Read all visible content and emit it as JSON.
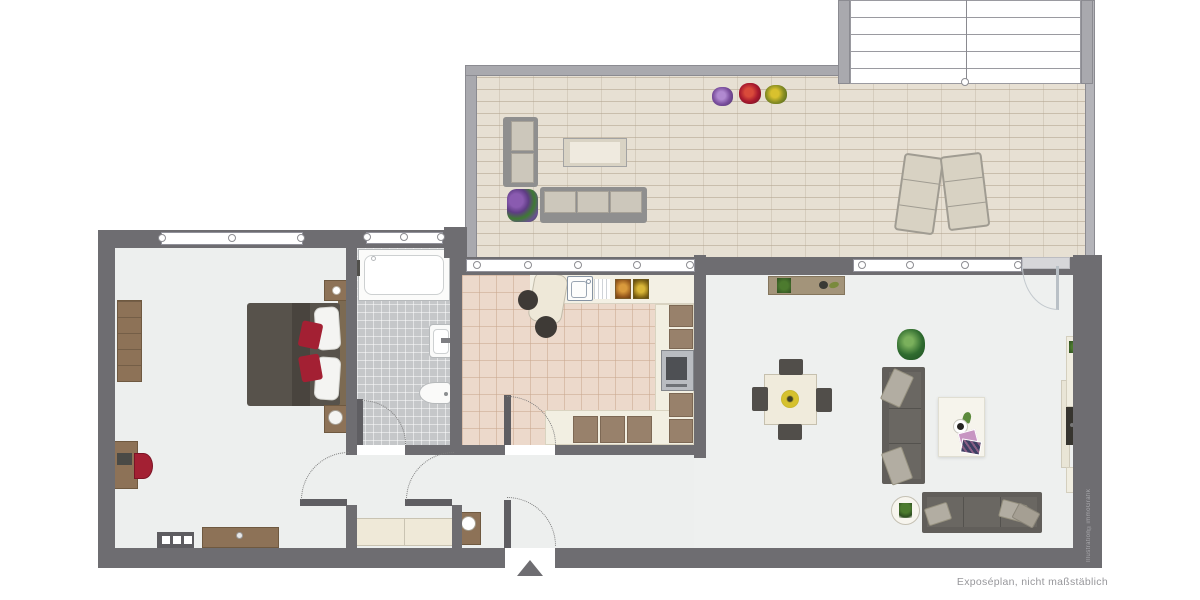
{
  "texts": {
    "caption": "Exposéplan, nicht maßstäblich",
    "watermark": "Illustration©immoGrafik"
  },
  "palette": {
    "wall_dark": "#6e6d71",
    "wall_terrace": "#a9a9ae",
    "floor_room": "#edefee",
    "floor_kitchen": "#ecd9cb",
    "floor_bathroom": "#c5c7c9",
    "floor_terrace": "#e7e0d3",
    "furniture_gray": "#615e5a",
    "wood_brown": "#8d7257",
    "counter_cream": "#f2efe2",
    "accent_red": "#a32033",
    "cushion_beige": "#b2ada2",
    "plant_green": "#2f6b2f",
    "white": "#ffffff"
  },
  "floorplan": {
    "rooms": [
      {
        "id": "terrace",
        "furniture": [
          "outdoor-sofa-2-seat",
          "outdoor-sofa-3-seat",
          "outdoor-coffee-table",
          "flower-box",
          "flower-pot-purple",
          "flower-pot-red",
          "flower-pot-yellow",
          "sun-lounger-left",
          "sun-lounger-right",
          "exterior-stairs"
        ]
      },
      {
        "id": "bedroom",
        "furniture": [
          "wardrobe",
          "double-bed",
          "pillows",
          "red-cushions",
          "nightstand-top",
          "nightstand-bottom",
          "desk",
          "desk-chair",
          "dresser",
          "radiator"
        ]
      },
      {
        "id": "bathroom",
        "furniture": [
          "bathtub",
          "washbasin",
          "toilet"
        ]
      },
      {
        "id": "kitchen",
        "furniture": [
          "bar-table",
          "bar-stools",
          "sink",
          "drainer",
          "cooktop-trays",
          "l-shaped-counter",
          "oven"
        ]
      },
      {
        "id": "hallway",
        "furniture": [
          "bench",
          "cabinet-with-mirror",
          "entrance-arrow"
        ]
      },
      {
        "id": "living-room",
        "furniture": [
          "sideboard",
          "dining-table",
          "dining-chairs",
          "floor-plant",
          "sofa-3-seat",
          "sofa-2-seat",
          "rug",
          "coffee-cup",
          "magazines",
          "round-side-table",
          "tv-lowboard",
          "tv"
        ]
      }
    ],
    "doors": [
      "entrance-door",
      "kitchen-door",
      "bedroom-door",
      "bathroom-door",
      "vestibule-door",
      "terrace-door"
    ],
    "windows": [
      "bedroom-window",
      "bathroom-window",
      "kitchen-window",
      "living-room-window"
    ]
  }
}
